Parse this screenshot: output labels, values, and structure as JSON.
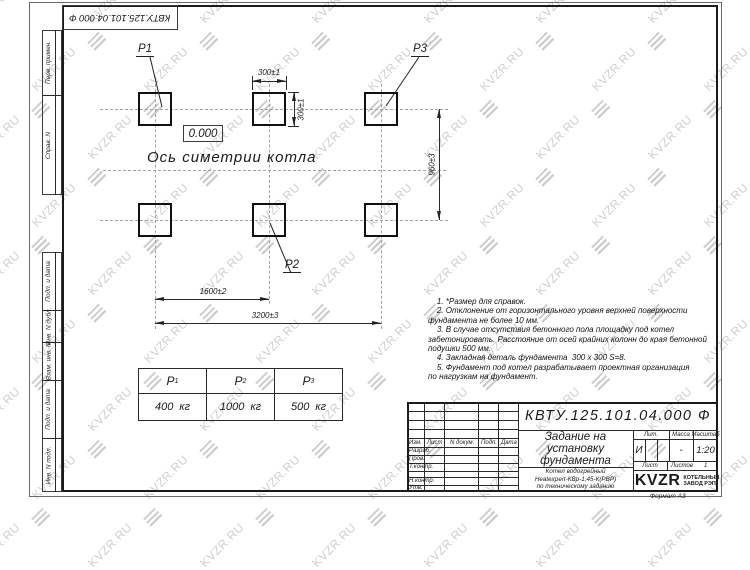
{
  "watermark": {
    "text": "KVZR.RU",
    "color": "#cfcfcf"
  },
  "stamp_top": {
    "doc_number": "КВТУ.125.101.04.000  Ф"
  },
  "side_column": {
    "cells": [
      {
        "label": "Перв. примен."
      },
      {
        "label": "Справ. N"
      },
      {
        "label": "Подп. и дата"
      },
      {
        "label": "Инв. N дубл."
      },
      {
        "label": "Взам. инв. N"
      },
      {
        "label": "Подп. и дата"
      },
      {
        "label": "Инв. N подл."
      }
    ]
  },
  "drawing": {
    "pad_labels": {
      "p1": "P1",
      "p2": "P2",
      "p3": "P3"
    },
    "elevation": "0.000",
    "axis_label": "Ось симетрии котла",
    "dims": {
      "pad_width": "300±1",
      "pad_height": "300±1",
      "row_spacing": "960±3",
      "half_span": "1600±2",
      "full_span": "3200±3"
    }
  },
  "notes": {
    "text": "    1. *Размер для справок.\n    2. Отклонение от горизонтального уровня верхней поверхности\nфундамента не более 10 мм.\n    3. В случае отсутствия бетонного пола площадку под котел\nзабетонировать. Расстояние от осей крайних колонн до края бетонной\nподушки 500 мм.\n    4. Закладная деталь фундамента  300 x 300 S=8.\n    5. Фундамент под котел разрабатывает проектная организация\nпо нагрузкам на фундамент."
  },
  "load_table": {
    "headers": [
      {
        "base": "P",
        "sub": "1"
      },
      {
        "base": "P",
        "sub": "2"
      },
      {
        "base": "P",
        "sub": "3"
      }
    ],
    "values": [
      "400  кг",
      "1000  кг",
      "500  кг"
    ]
  },
  "title_block": {
    "doc_number": "КВТУ.125.101.04.000  Ф",
    "title": "Задание на\nустановку\nфундамента",
    "subtitle": "Котел водогрейный\nHeatexpert-КВр-1,45-К(РВР)\nпо техническому заданию",
    "header_cols": {
      "izm": "Изм.",
      "list": "Лист",
      "ndok": "N докум.",
      "podp": "Подп.",
      "data": "Дата"
    },
    "rows": {
      "razrab": "Разраб.",
      "prov": "Пров.",
      "tkontr": "Т.контр.",
      "nkontr": "Н.контр.",
      "utv": "Утв."
    },
    "lit_label": "Лит.",
    "lit_value": "И",
    "mass_label": "Масса",
    "mass_value": "-",
    "scale_label": "Масштаб",
    "scale_value": "1:20",
    "sheet_label": "Лист",
    "sheets_label": "Листов",
    "sheets_value": "1",
    "logo_text": "KVZR",
    "logo_caption": "КОТЕЛЬНЫЙ\nЗАВОД РЭП",
    "format_label": "Формат А3"
  }
}
